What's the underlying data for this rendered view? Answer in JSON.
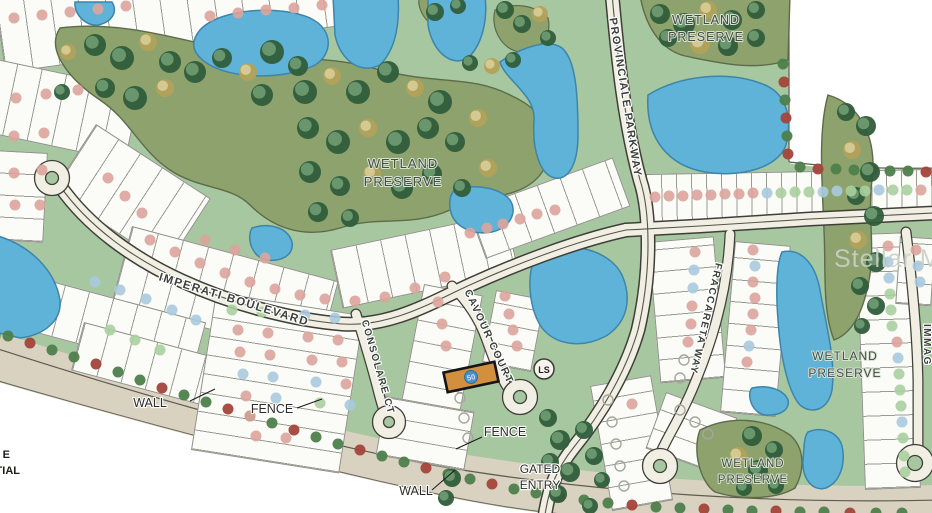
{
  "map": {
    "streets": {
      "imperati": "IMPERATI BOULEVARD",
      "provinciale": "PROVINCIALE PARKWAY",
      "cavour": "CAVOUR COURT",
      "consolare": "CONSOLARE CT",
      "fraccareta": "FRACCARETA WAY",
      "immag": "IMMAG"
    },
    "wetland": {
      "line1": "WETLAND",
      "line2": "PRESERVE"
    },
    "labels": {
      "wall": "WALL",
      "fence": "FENCE",
      "gated1": "GATED",
      "gated2": "ENTRY",
      "lift_station": "LS",
      "legend_frag1": "E",
      "legend_frag2": "TIAL",
      "subject_lot_number": "50"
    },
    "watermark": "Stellar MLS",
    "legend_colors": {
      "lot_pink": "#dca49b",
      "lot_blue": "#a9cade",
      "lot_green": "#a9cf9e",
      "lot_open_ring": "#a6a69e",
      "water": "#5fb2d8",
      "road": "#f1eee3",
      "wetland": "#8da26c",
      "tree_dark": "#2f5d3b",
      "tree_khaki": "#b3a25b",
      "shrub_green": "#4e7f4c",
      "shrub_red": "#a3453a",
      "wall_band": "#d9d2c1",
      "subject_highlight": "#d2903e",
      "subject_dot": "#4a90c8"
    }
  }
}
